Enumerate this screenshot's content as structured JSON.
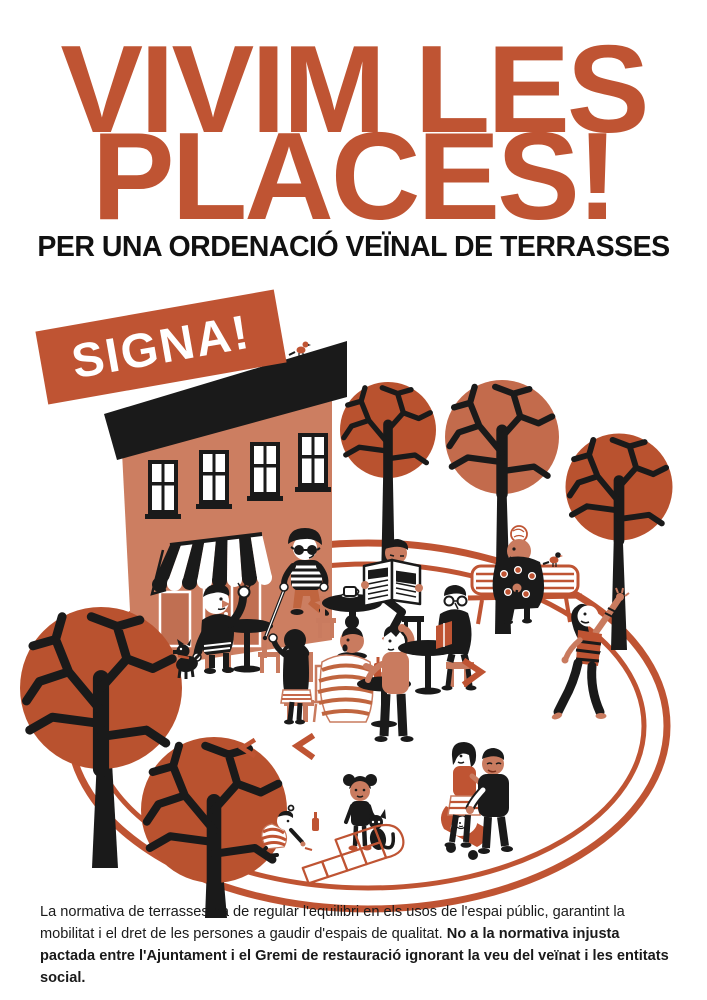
{
  "poster": {
    "title_line1": "VIVIM LES",
    "title_line2": "PLACES!",
    "subtitle": "PER UNA ORDENACIÓ VEÏNAL DE TERRASSES",
    "badge_label": "SIGNA!",
    "footer": {
      "regular": "La normativa de terrasses ha de regular l'equilibri en els usos de l'espai públic, garantint la mobilitat i el dret de les persones a gaudir d'espais de qualitat. ",
      "bold": "No a la normativa injusta pactada entre l'Ajuntament i el Gremi de restauració ignorant la veu del veïnat i les entitats social."
    },
    "colors": {
      "terracotta": "#BF5433",
      "salmon_building": "#CC7E61",
      "skin": "#C97B5F",
      "black": "#1A1A1A",
      "white": "#FFFFFF"
    }
  }
}
